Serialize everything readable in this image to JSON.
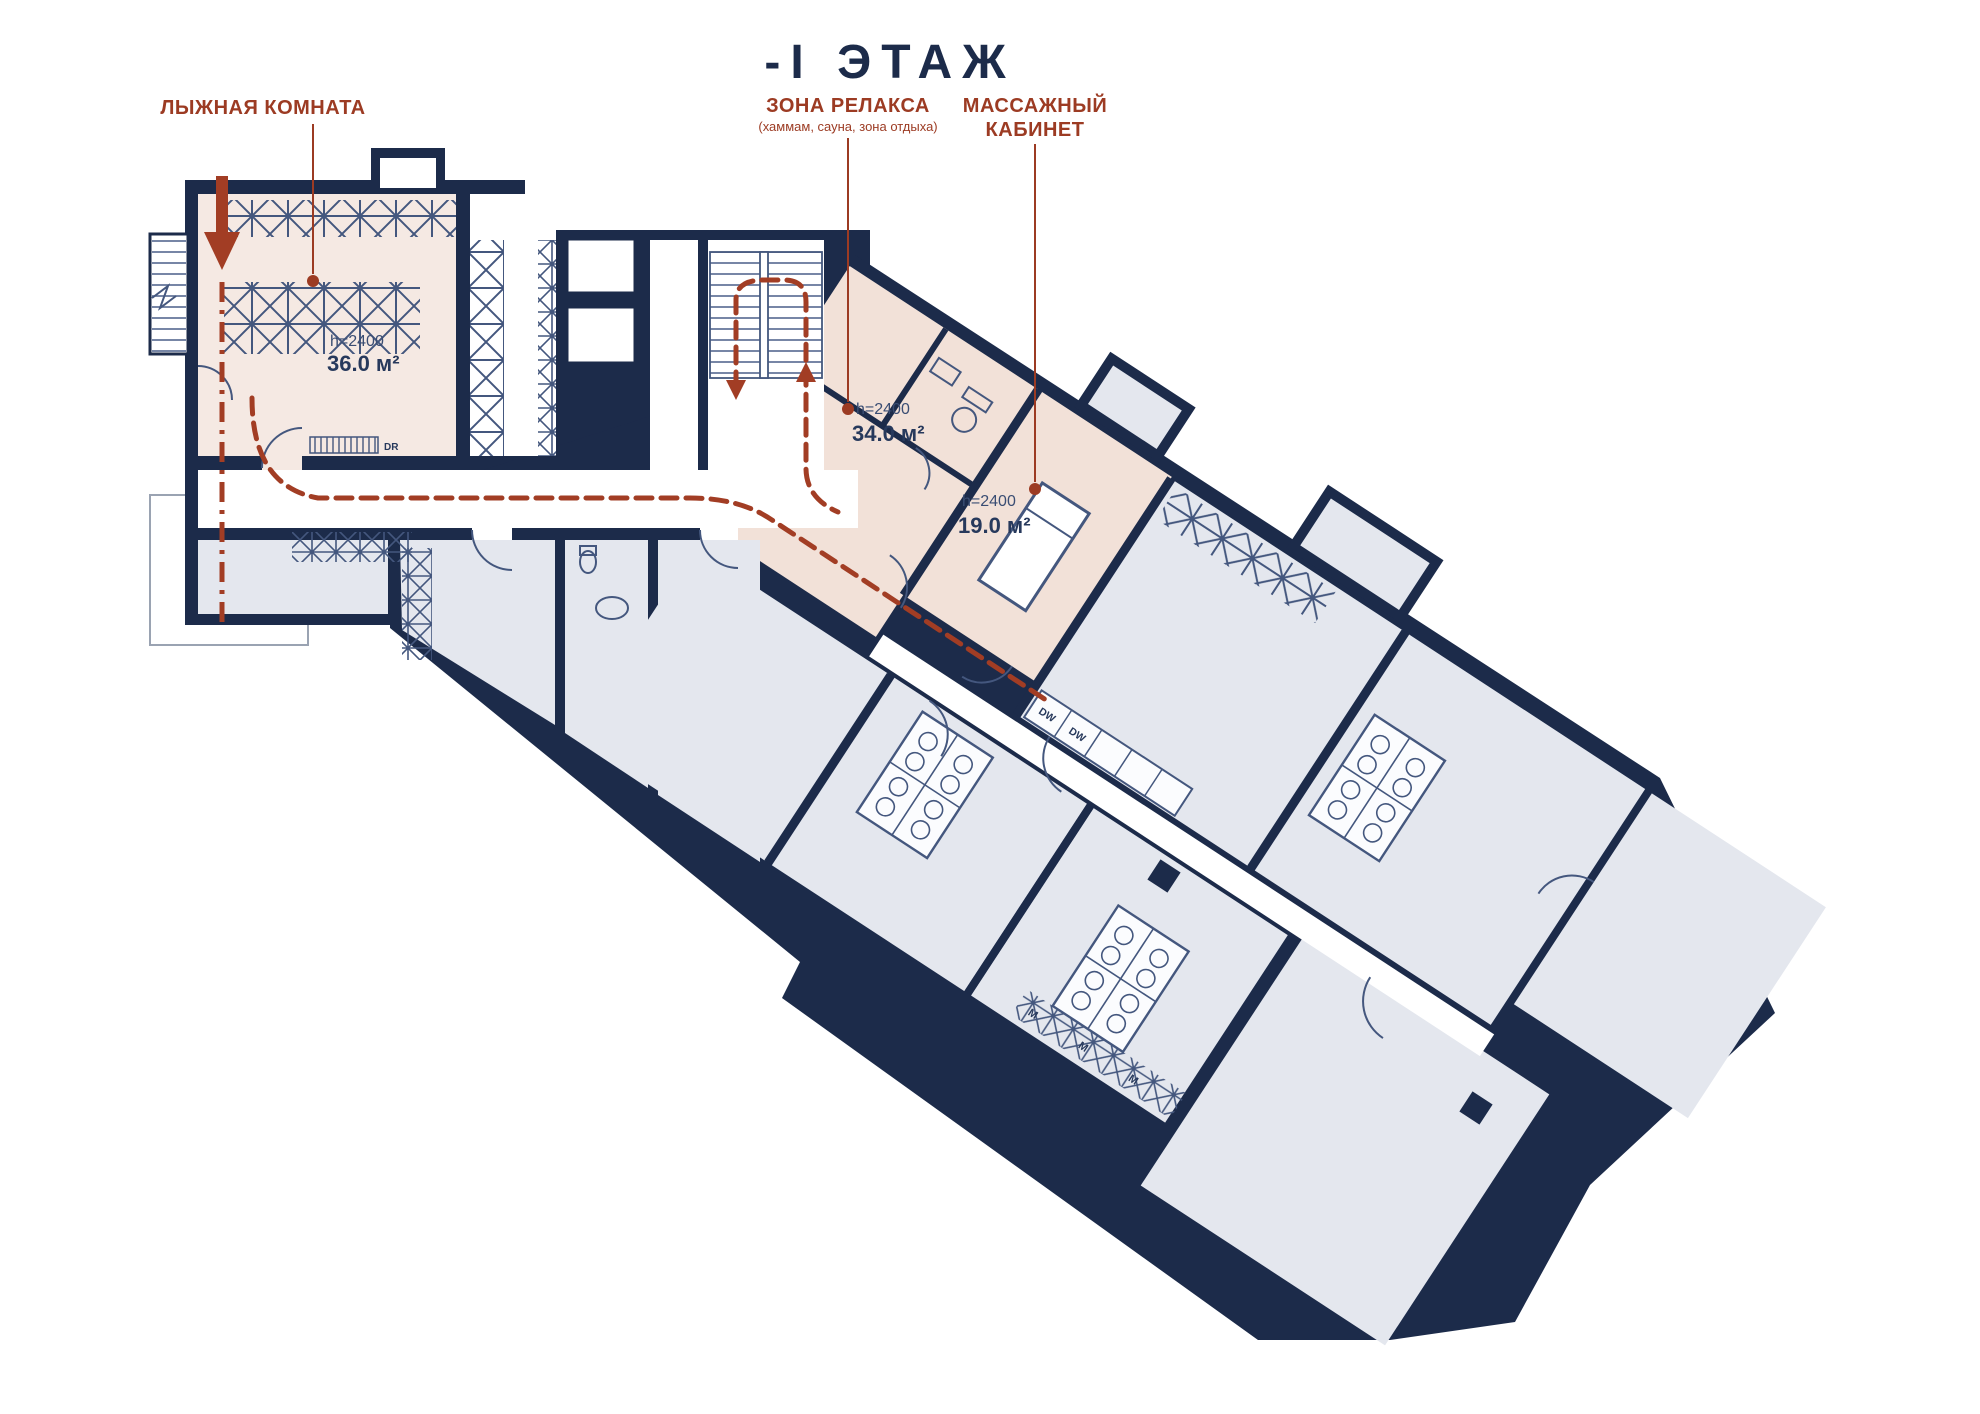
{
  "title": "-I  ЭТАЖ",
  "annotations": [
    {
      "label": "ЛЫЖНАЯ КОМНАТА",
      "sublabel": ""
    },
    {
      "label": "ЗОНА РЕЛАКСА",
      "sublabel": "(хаммам, сауна, зона отдыха)"
    },
    {
      "label": "МАССАЖНЫЙ",
      "label2": "КАБИНЕТ"
    }
  ],
  "rooms": [
    {
      "name": "ski-room",
      "height": "h=2400",
      "area": "36.0 м²"
    },
    {
      "name": "relax-zone",
      "height": "h=2400",
      "area": "34.0 м²"
    },
    {
      "name": "massage-room",
      "height": "h=2400",
      "area": "19.0 м²"
    }
  ],
  "markers": {
    "dishwasher": "DW",
    "dryer": "DR",
    "wardrobe": "M"
  },
  "colors": {
    "wall": "#1c2b4a",
    "wall_thin": "#44577e",
    "room_gray": "#e4e7ee",
    "room_pink": "#f2e1d8",
    "room_pink_light": "#f5e9e3",
    "accent_red": "#9c3b23",
    "route_red": "#a23d24",
    "text_navy": "#27395c"
  }
}
